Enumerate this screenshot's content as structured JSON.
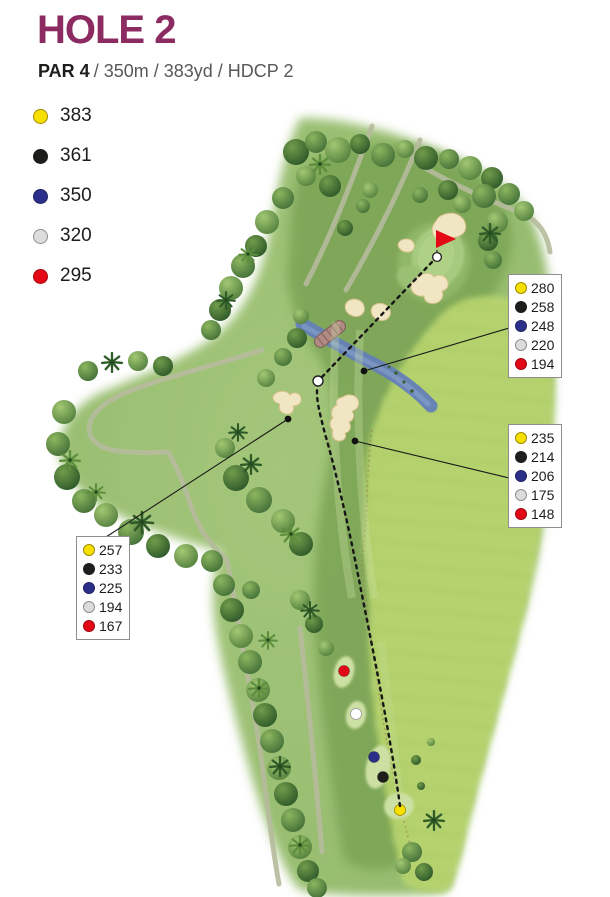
{
  "header": {
    "title": "HOLE 2",
    "par": "PAR 4",
    "details": "/ 350m / 383yd / HDCP 2"
  },
  "tee_legend": {
    "items": [
      {
        "tee": "yellow",
        "distance": "383"
      },
      {
        "tee": "black",
        "distance": "361"
      },
      {
        "tee": "blue",
        "distance": "350"
      },
      {
        "tee": "white",
        "distance": "320"
      },
      {
        "tee": "red",
        "distance": "295"
      }
    ]
  },
  "callouts": {
    "upper_right": {
      "values": [
        {
          "tee": "yellow",
          "distance": "280"
        },
        {
          "tee": "black",
          "distance": "258"
        },
        {
          "tee": "blue",
          "distance": "248"
        },
        {
          "tee": "white",
          "distance": "220"
        },
        {
          "tee": "red",
          "distance": "194"
        }
      ]
    },
    "middle_right": {
      "values": [
        {
          "tee": "yellow",
          "distance": "235"
        },
        {
          "tee": "black",
          "distance": "214"
        },
        {
          "tee": "blue",
          "distance": "206"
        },
        {
          "tee": "white",
          "distance": "175"
        },
        {
          "tee": "red",
          "distance": "148"
        }
      ]
    },
    "left": {
      "values": [
        {
          "tee": "yellow",
          "distance": "257"
        },
        {
          "tee": "black",
          "distance": "233"
        },
        {
          "tee": "blue",
          "distance": "225"
        },
        {
          "tee": "white",
          "distance": "194"
        },
        {
          "tee": "red",
          "distance": "167"
        }
      ]
    }
  },
  "colors": {
    "title": "#8C2A62",
    "tee_yellow": "#F7E000",
    "tee_black": "#1D1D1B",
    "tee_blue": "#2B2F8A",
    "tee_white": "#DCDCDC",
    "tee_red": "#E30917",
    "flag": "#E30917",
    "water": "#637FB8",
    "bunker": "#F1E6C3",
    "fairway": "#7DA557",
    "rough": "#B7D46E"
  }
}
